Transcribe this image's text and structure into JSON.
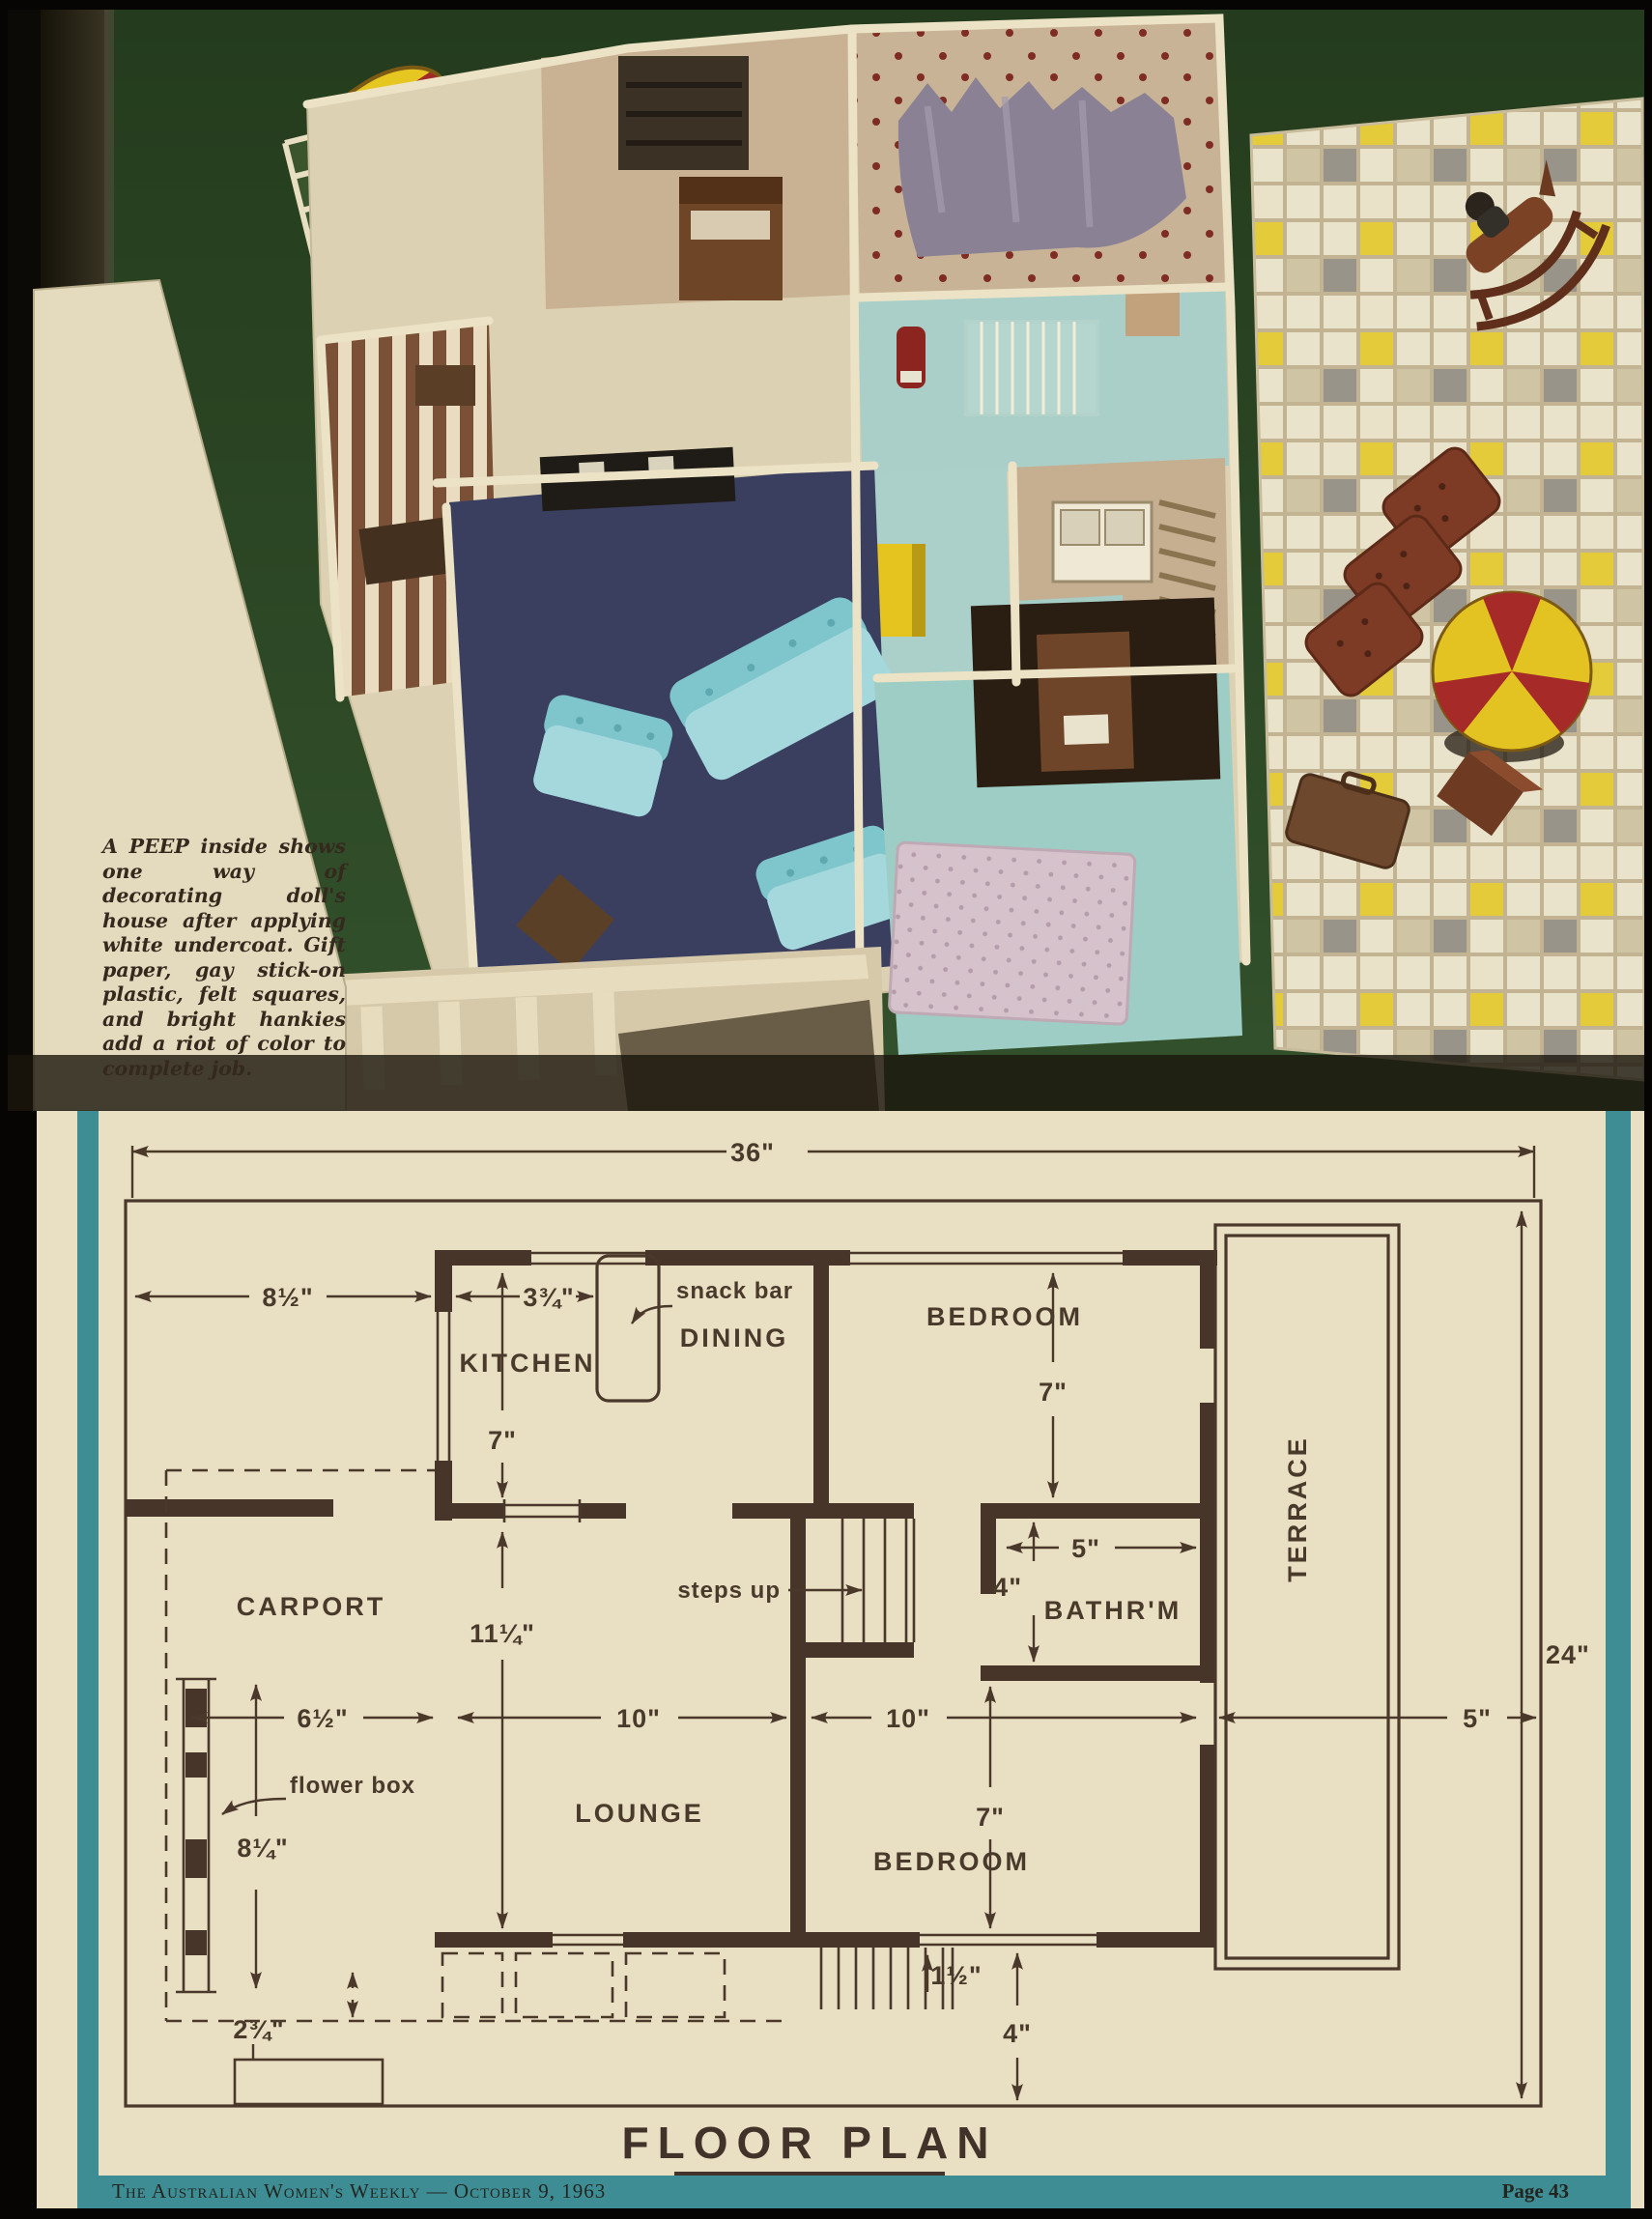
{
  "photo": {
    "caption": "A PEEP inside shows one way of decorating doll's house after applying white undercoat. Gift paper, gay stick-on plastic, felt squares, and bright hankies add a riot of color to complete job."
  },
  "plan": {
    "title": "FLOOR PLAN",
    "rooms": {
      "kitchen": "KITCHEN",
      "dining": "DINING",
      "carport": "CARPORT",
      "lounge": "LOUNGE",
      "bedroom_top": "BEDROOM",
      "bedroom_bottom": "BEDROOM",
      "bathroom": "BATHR'M",
      "terrace": "TERRACE"
    },
    "callouts": {
      "snack_bar": "snack bar",
      "steps_up": "steps up",
      "flower_box": "flower box"
    },
    "dims": {
      "overall_w": "36\"",
      "overall_h": "24\"",
      "carport_w": "8½\"",
      "kitchen_w": "3¾\"",
      "kitchen_d": "7\"",
      "bedroom_top_d": "7\"",
      "bath_w": "5\"",
      "bath_d": "4\"",
      "hall_d": "11¼\"",
      "carport_inner": "6½\"",
      "lounge_w": "10\"",
      "bedroom_w": "10\"",
      "terrace_w": "5\"",
      "flower_box_l": "8¼\"",
      "kerb": "2¾\"",
      "bedroom_bot_d": "7\"",
      "step": "1½\"",
      "setback": "4\""
    }
  },
  "footer": {
    "left": "The Australian Women's Weekly — October 9, 1963",
    "right": "Page 43"
  },
  "colors": {
    "teal_frame": "#3e8d95",
    "plan_ink": "#4a382b",
    "paper": "#e9dfc2",
    "photo_green": "#2b4425",
    "lounge_floor": "#3a3f60",
    "aqua_floor": "#a9cfc8",
    "awning_yellow": "#e6c722",
    "awning_red": "#a22a26"
  }
}
